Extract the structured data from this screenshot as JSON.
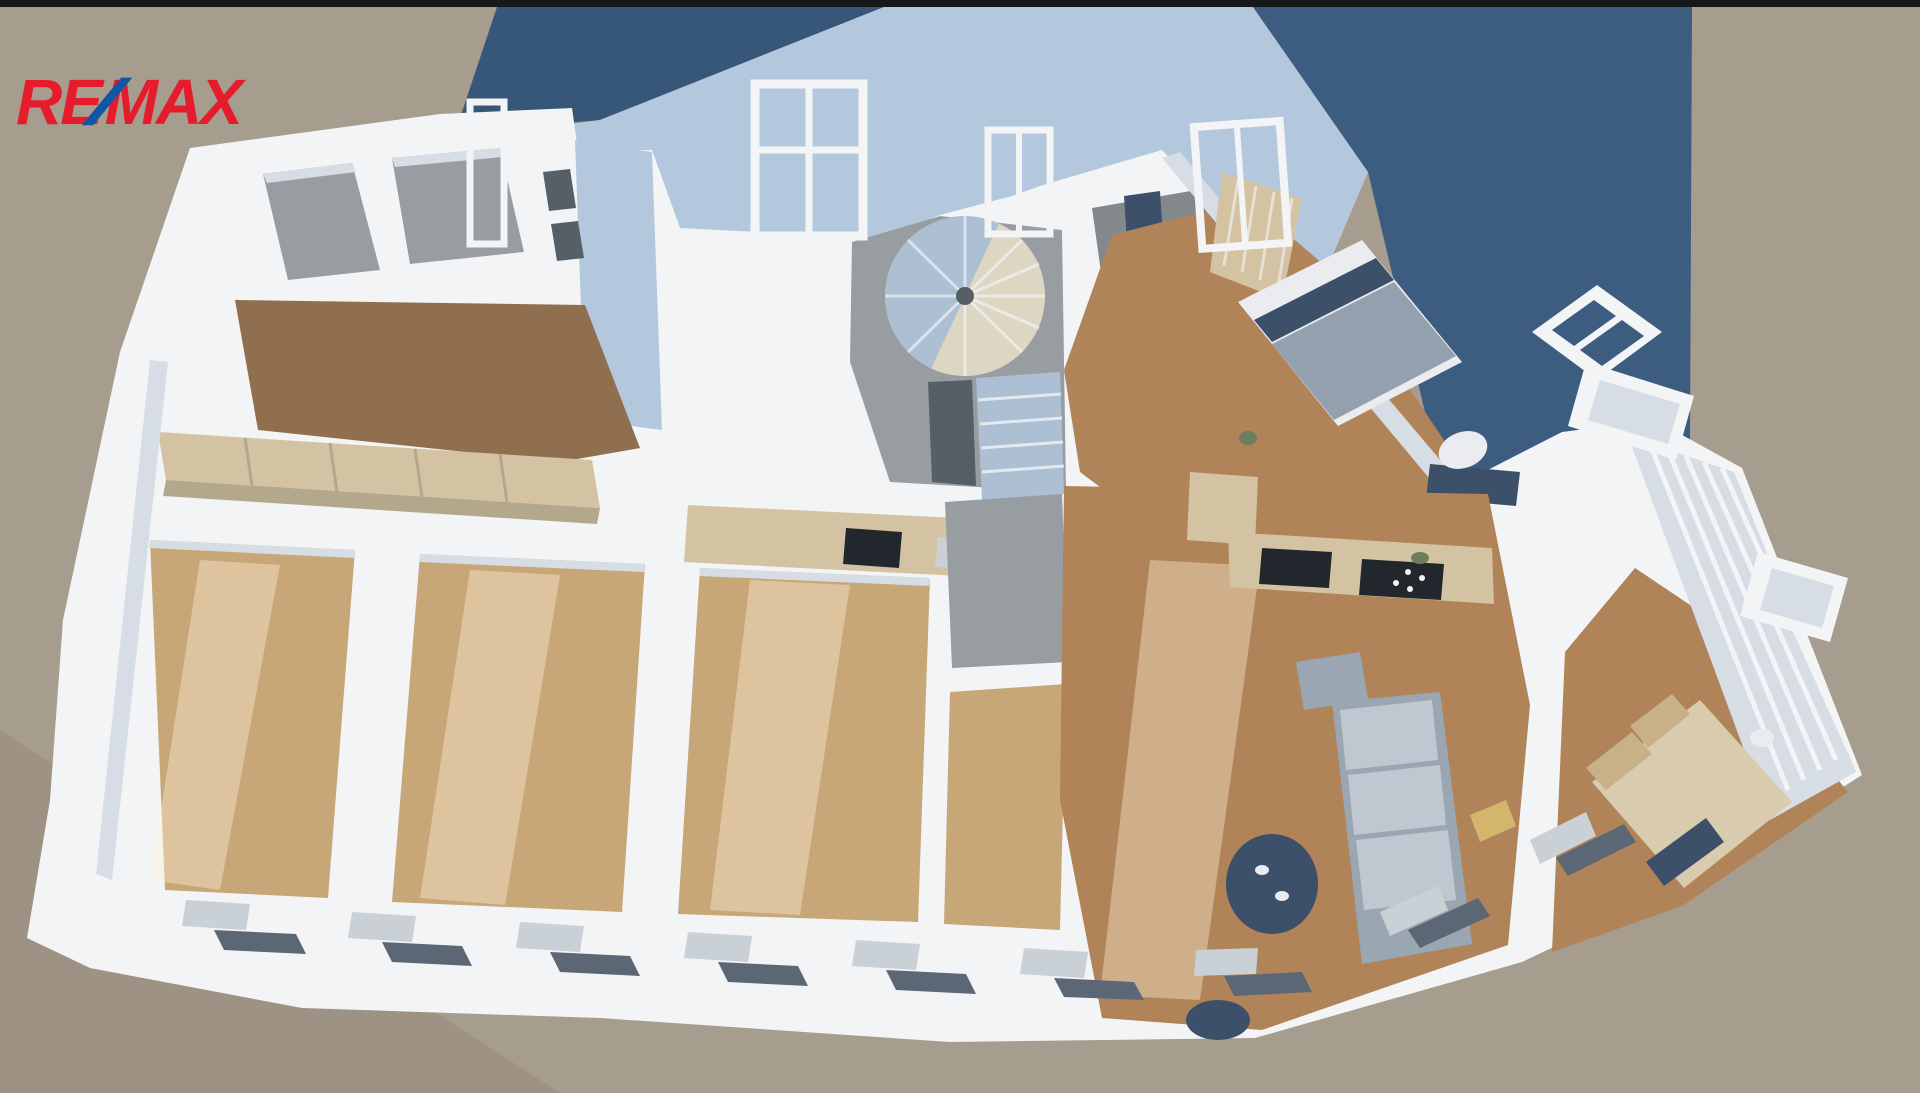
{
  "logo": {
    "part1": "RE",
    "slash": "/",
    "part2": "MAX",
    "red": "#e61b2c",
    "blue": "#1155a6"
  },
  "colors": {
    "top_bar": "#17181a",
    "ground": "#a69d8f",
    "ground_dark": "#9d9283",
    "roof_dark": "#3c5c80",
    "roof_dark2": "#365778",
    "roof_light": "#b4c8dd",
    "wall": "#f3f4f6",
    "wall_shade": "#d7dde4",
    "sill": "#c9d0d6",
    "wood_dark": "#8f6f4e",
    "wood_mid": "#b08358",
    "wood_light": "#c7a678",
    "tile": "#989da2",
    "tile_dark": "#83888d",
    "tile_darker": "#565e66",
    "stair_blue": "#acbfd3",
    "stair_cream": "#ddd6c2",
    "counter_beige": "#d4c3a2",
    "counter_face": "#b3a88c",
    "appliance_dark": "#22272e",
    "sofa": "#9aa6b2",
    "sofa_light": "#bfc7d0",
    "navy": "#3d5069",
    "bed_white": "#eaecef",
    "bed_gray": "#93a0ae",
    "bed_cream": "#d8cbae",
    "pillow_tan": "#c8b088",
    "pillow_yellow": "#d3b56c",
    "window_opening": "#5b6774",
    "plant": "#6c7f5c",
    "sun": "rgba(255,243,214,0.40)",
    "shadow": "rgba(96,84,64,0.16)"
  }
}
